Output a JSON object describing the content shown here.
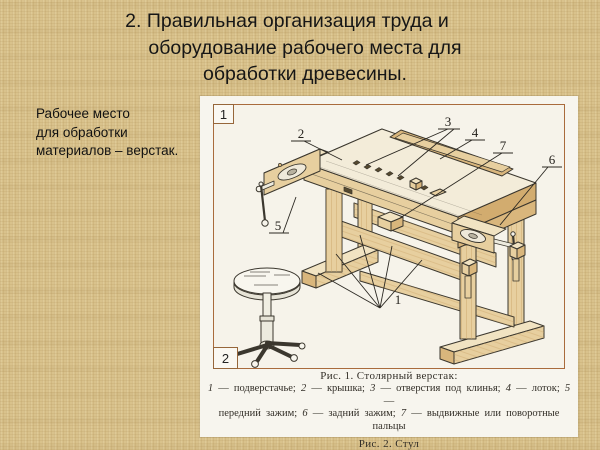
{
  "slide": {
    "title_lines": {
      "l1": "2. Правильная организация труда и",
      "l2": "оборудование рабочего места для",
      "l3": "обработки древесины."
    },
    "sidenote_lines": {
      "l1": "Рабочее место",
      "l2": "для обработки",
      "l3": "материалов – верстак."
    }
  },
  "figure": {
    "corner_label_top": "1",
    "corner_label_bottom": "2",
    "part_labels": [
      {
        "n": "2",
        "x": 87,
        "y": 33
      },
      {
        "n": "3",
        "x": 234,
        "y": 21
      },
      {
        "n": "4",
        "x": 261,
        "y": 32
      },
      {
        "n": "7",
        "x": 289,
        "y": 45
      },
      {
        "n": "6",
        "x": 338,
        "y": 59
      },
      {
        "n": "5",
        "x": 64,
        "y": 125
      },
      {
        "n": "1",
        "x": 184,
        "y": 199
      }
    ],
    "caption_fig1": "Рис. 1. Столярный верстак:",
    "caption_fig2": "Рис. 2. Стул",
    "legend_line1_segments": [
      {
        "t": "1",
        "i": 1
      },
      {
        "t": " — подверстачье;  ",
        "i": 0
      },
      {
        "t": "2",
        "i": 1
      },
      {
        "t": " — крышка;  ",
        "i": 0
      },
      {
        "t": "3",
        "i": 1
      },
      {
        "t": " — отверстия под клинья;  ",
        "i": 0
      },
      {
        "t": "4",
        "i": 1
      },
      {
        "t": " — лоток;  ",
        "i": 0
      },
      {
        "t": "5",
        "i": 1
      },
      {
        "t": " —",
        "i": 0
      }
    ],
    "legend_line2_segments": [
      {
        "t": "передний зажим;  ",
        "i": 0
      },
      {
        "t": "6",
        "i": 1
      },
      {
        "t": " — задний зажим;  ",
        "i": 0
      },
      {
        "t": "7",
        "i": 1
      },
      {
        "t": " — выдвижные или поворотные пальцы",
        "i": 0
      }
    ]
  },
  "colors": {
    "background": "#d9c28c",
    "panel": "#f7f5ee",
    "frame_border": "#a96b3c",
    "wood_light": "#f1e3c2",
    "wood_mid": "#e7cf9f",
    "wood_dark": "#d9b67c",
    "line": "#3b372e"
  }
}
